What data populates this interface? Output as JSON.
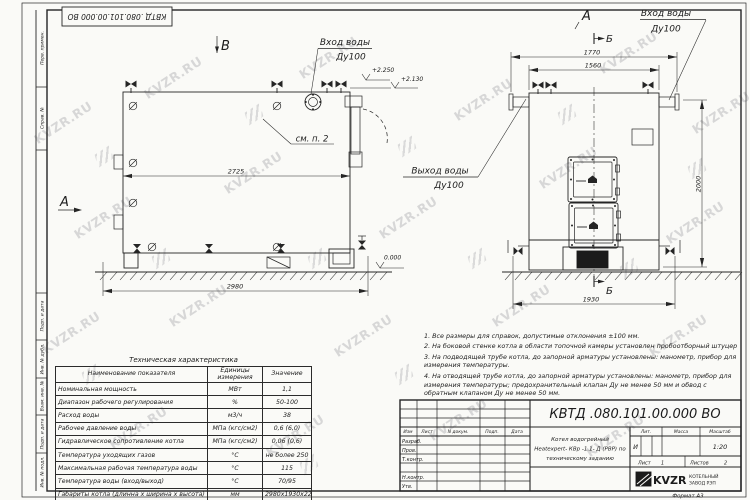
{
  "watermark": {
    "text": "KVZR.RU"
  },
  "frame": {
    "stamp_top": "КВТД .080.101.00.000  ВО",
    "margin_labels": [
      "Перв. примен.",
      "Справ. №",
      "Подп. и дата",
      "Инв. № дубл.",
      "Взам. инв. №",
      "Подп. и дата",
      "Инв. № подл."
    ]
  },
  "views": {
    "side": {
      "view_b": "В",
      "view_a": "А",
      "inlet_line1": "Вход воды",
      "inlet_line2": "Ду100",
      "see_note": "см. п. 2",
      "dim_length_inner": "2725",
      "dim_length_overall": "2980",
      "elev_top_flange": "+2.250",
      "elev_top_shell": "+2.130",
      "elev_ground": "0.000"
    },
    "front": {
      "view_a": "А",
      "section_b_top": "Б",
      "section_b_bottom": "Б",
      "inlet_line1": "Вход воды",
      "inlet_line2": "Ду100",
      "outlet_line1": "Выход воды",
      "outlet_line2": "Ду100",
      "dim_width_flanges": "1770",
      "dim_width_shell": "1560",
      "dim_width_base": "1930",
      "dim_height": "2000"
    }
  },
  "notes": [
    "1. Все размеры для справок, допустимые отклонения ±100 мм.",
    "2. На боковой стенке котла в области топочной камеры установлен пробоотборный штуцер",
    "3. На подводящей трубе котла, до запорной арматуры установлены: манометр, прибор для измерения температуры.",
    "4. На отводящей трубе котла, до запорной арматуры установлены: манометр, прибор для измерения температуры; предохранительный клапан Ду не менее 50 мм и обвод с обратным клапаном Ду не менее 50 мм."
  ],
  "tech_table": {
    "title": "Техническая характеристика",
    "headers": [
      "Наименование показателя",
      "Единицы измерения",
      "Значение"
    ],
    "rows": [
      [
        "Номинальная мощность",
        "МВт",
        "1,1"
      ],
      [
        "Диапазон рабочего регулирования",
        "%",
        "50-100"
      ],
      [
        "Расход воды",
        "м3/ч",
        "38"
      ],
      [
        "Рабочее давление воды",
        "МПа (кгс/см2)",
        "0,6 (6,0)"
      ],
      [
        "Гидравлическое сопротивление котла",
        "МПа (кгс/см2)",
        "0,06 (0,6)"
      ],
      [
        "Температура уходящих газов",
        "°С",
        "не более 250"
      ],
      [
        "Максимальная рабочая температура воды",
        "°С",
        "115"
      ],
      [
        "Температура воды (вход/выход)",
        "°С",
        "70/95"
      ],
      [
        "Габариты котла (длинна х ширина х высота)",
        "мм",
        "2980х1930х2250"
      ]
    ]
  },
  "title_block": {
    "designation": "КВТД .080.101.00.000  ВО",
    "name_line1": "Котел водогрейный",
    "name_line2": "Heatexpert- КВр -1.1- Д (РВР) по",
    "name_line3": "техническому заданию",
    "col_izm": "Изм",
    "col_list": "Лист",
    "col_doc": "N докум.",
    "col_podp": "Подп.",
    "col_data": "Дата",
    "row_razrab": "Разраб.",
    "row_prov": "Пров.",
    "row_tkontr": "Т.контр.",
    "row_nkontr": "Н.контр.",
    "row_utv": "Утв.",
    "lit_label": "Лит.",
    "lit_value": "И",
    "mass_label": "Масса",
    "scale_label": "Масштаб",
    "scale_value": "1:20",
    "sheet_label": "Лист",
    "sheet_value": "1",
    "sheets_label": "Листов",
    "sheets_value": "2",
    "company_logo": "KVZR",
    "company_line1": "КОТЕЛЬНЫЙ",
    "company_line2": "ЗАВОД РЭП",
    "format_label": "Формат  А3"
  }
}
